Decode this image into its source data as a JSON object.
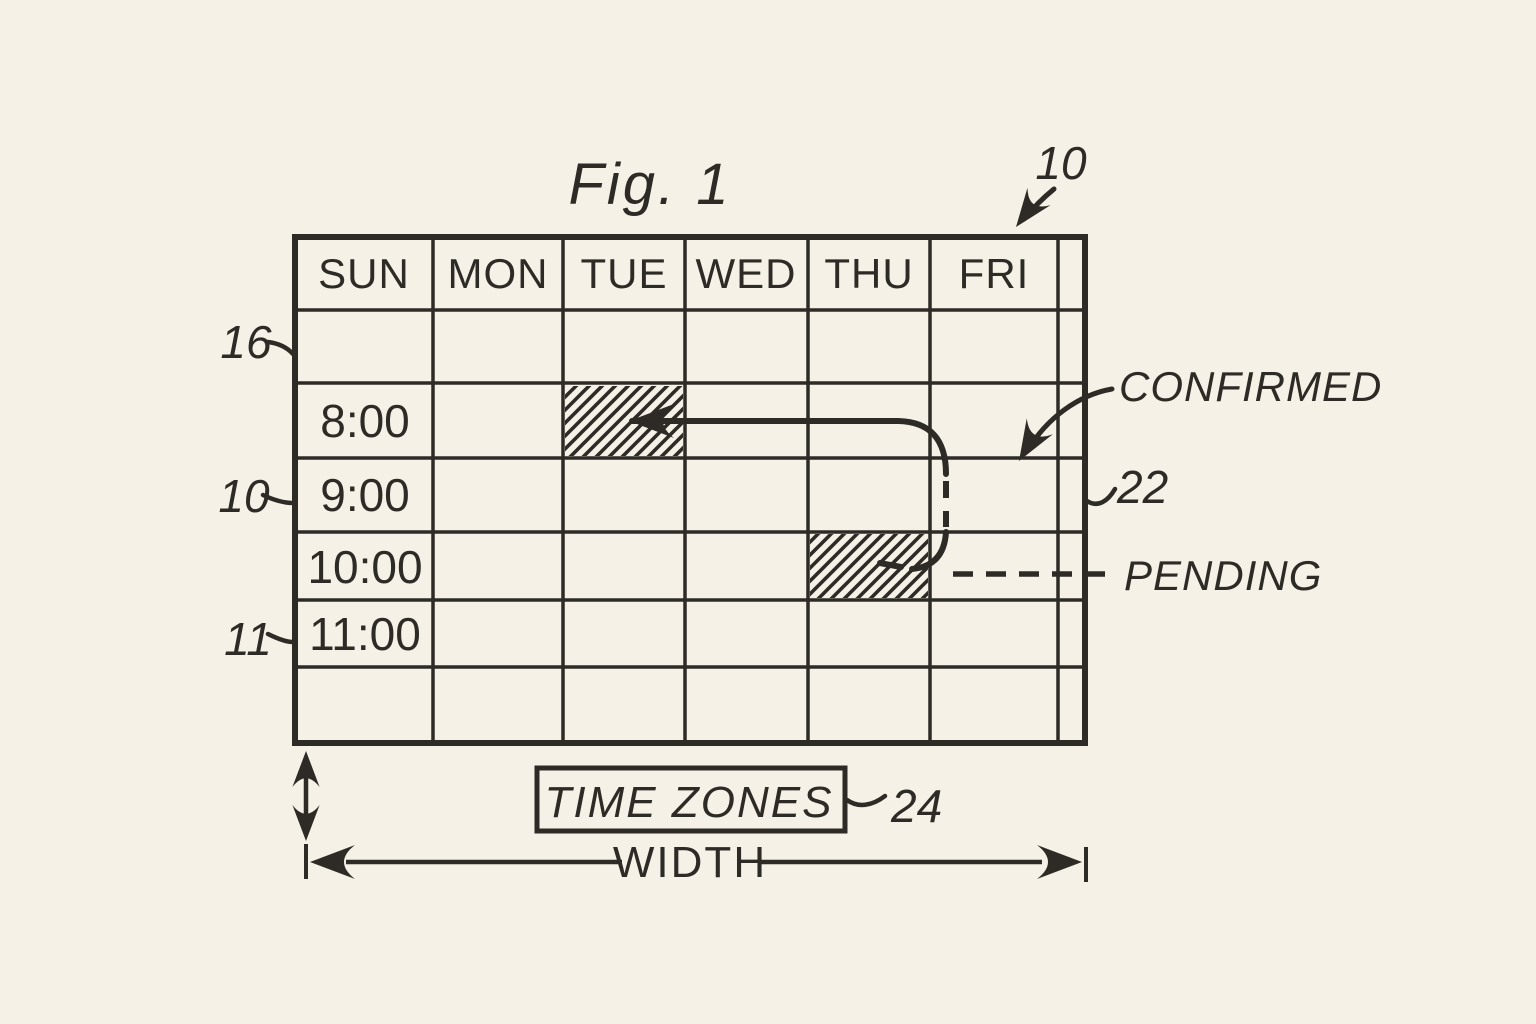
{
  "figure": {
    "title": "Fig. 1"
  },
  "schedule": {
    "days": [
      "SUN",
      "MON",
      "TUE",
      "WED",
      "THU",
      "FRI"
    ],
    "times": [
      "8:00",
      "9:00",
      "10:00",
      "11:00"
    ],
    "events": [
      {
        "day": "TUE",
        "time": "8:00",
        "status": "confirmed",
        "style": "hatched"
      },
      {
        "day": "THU",
        "time": "10:00",
        "status": "pending",
        "style": "hatched"
      }
    ],
    "reschedule_arrow": {
      "from": "THU 10:00",
      "to": "TUE 8:00"
    }
  },
  "labels": {
    "confirmed": "CONFIRMED",
    "pending": "PENDING",
    "time_zones": "TIME ZONES",
    "width": "WIDTH"
  },
  "refs": {
    "grid_top": "10",
    "header_row": "16",
    "time_row": "10",
    "row_11": "11",
    "right_edge": "22",
    "time_zones_box": "24"
  },
  "colors": {
    "paper": "#f5f1e6",
    "ink": "#2e2b26"
  }
}
